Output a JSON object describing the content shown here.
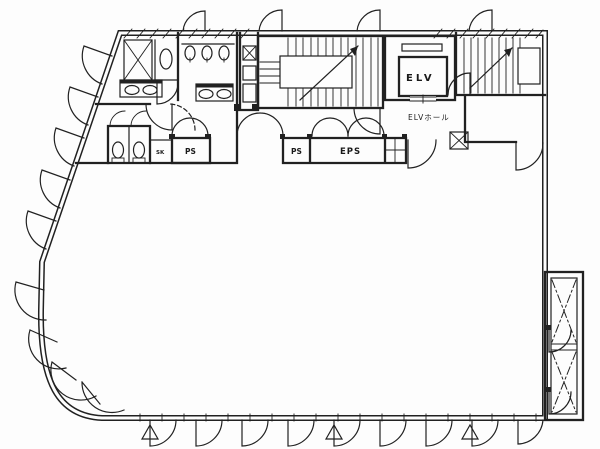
{
  "document": {
    "type": "architectural-floor-plan",
    "description": "Office building typical floor plan, line drawing"
  },
  "labels": {
    "elevator": "ELV",
    "elevator_hall": "ELVホール",
    "pipe_space_left": "PS",
    "pipe_space_center": "PS",
    "electrical_pipe_space": "EPS",
    "slop_sink": "SK"
  },
  "colors": {
    "line": "#212121",
    "background": "#fdfdfd"
  }
}
